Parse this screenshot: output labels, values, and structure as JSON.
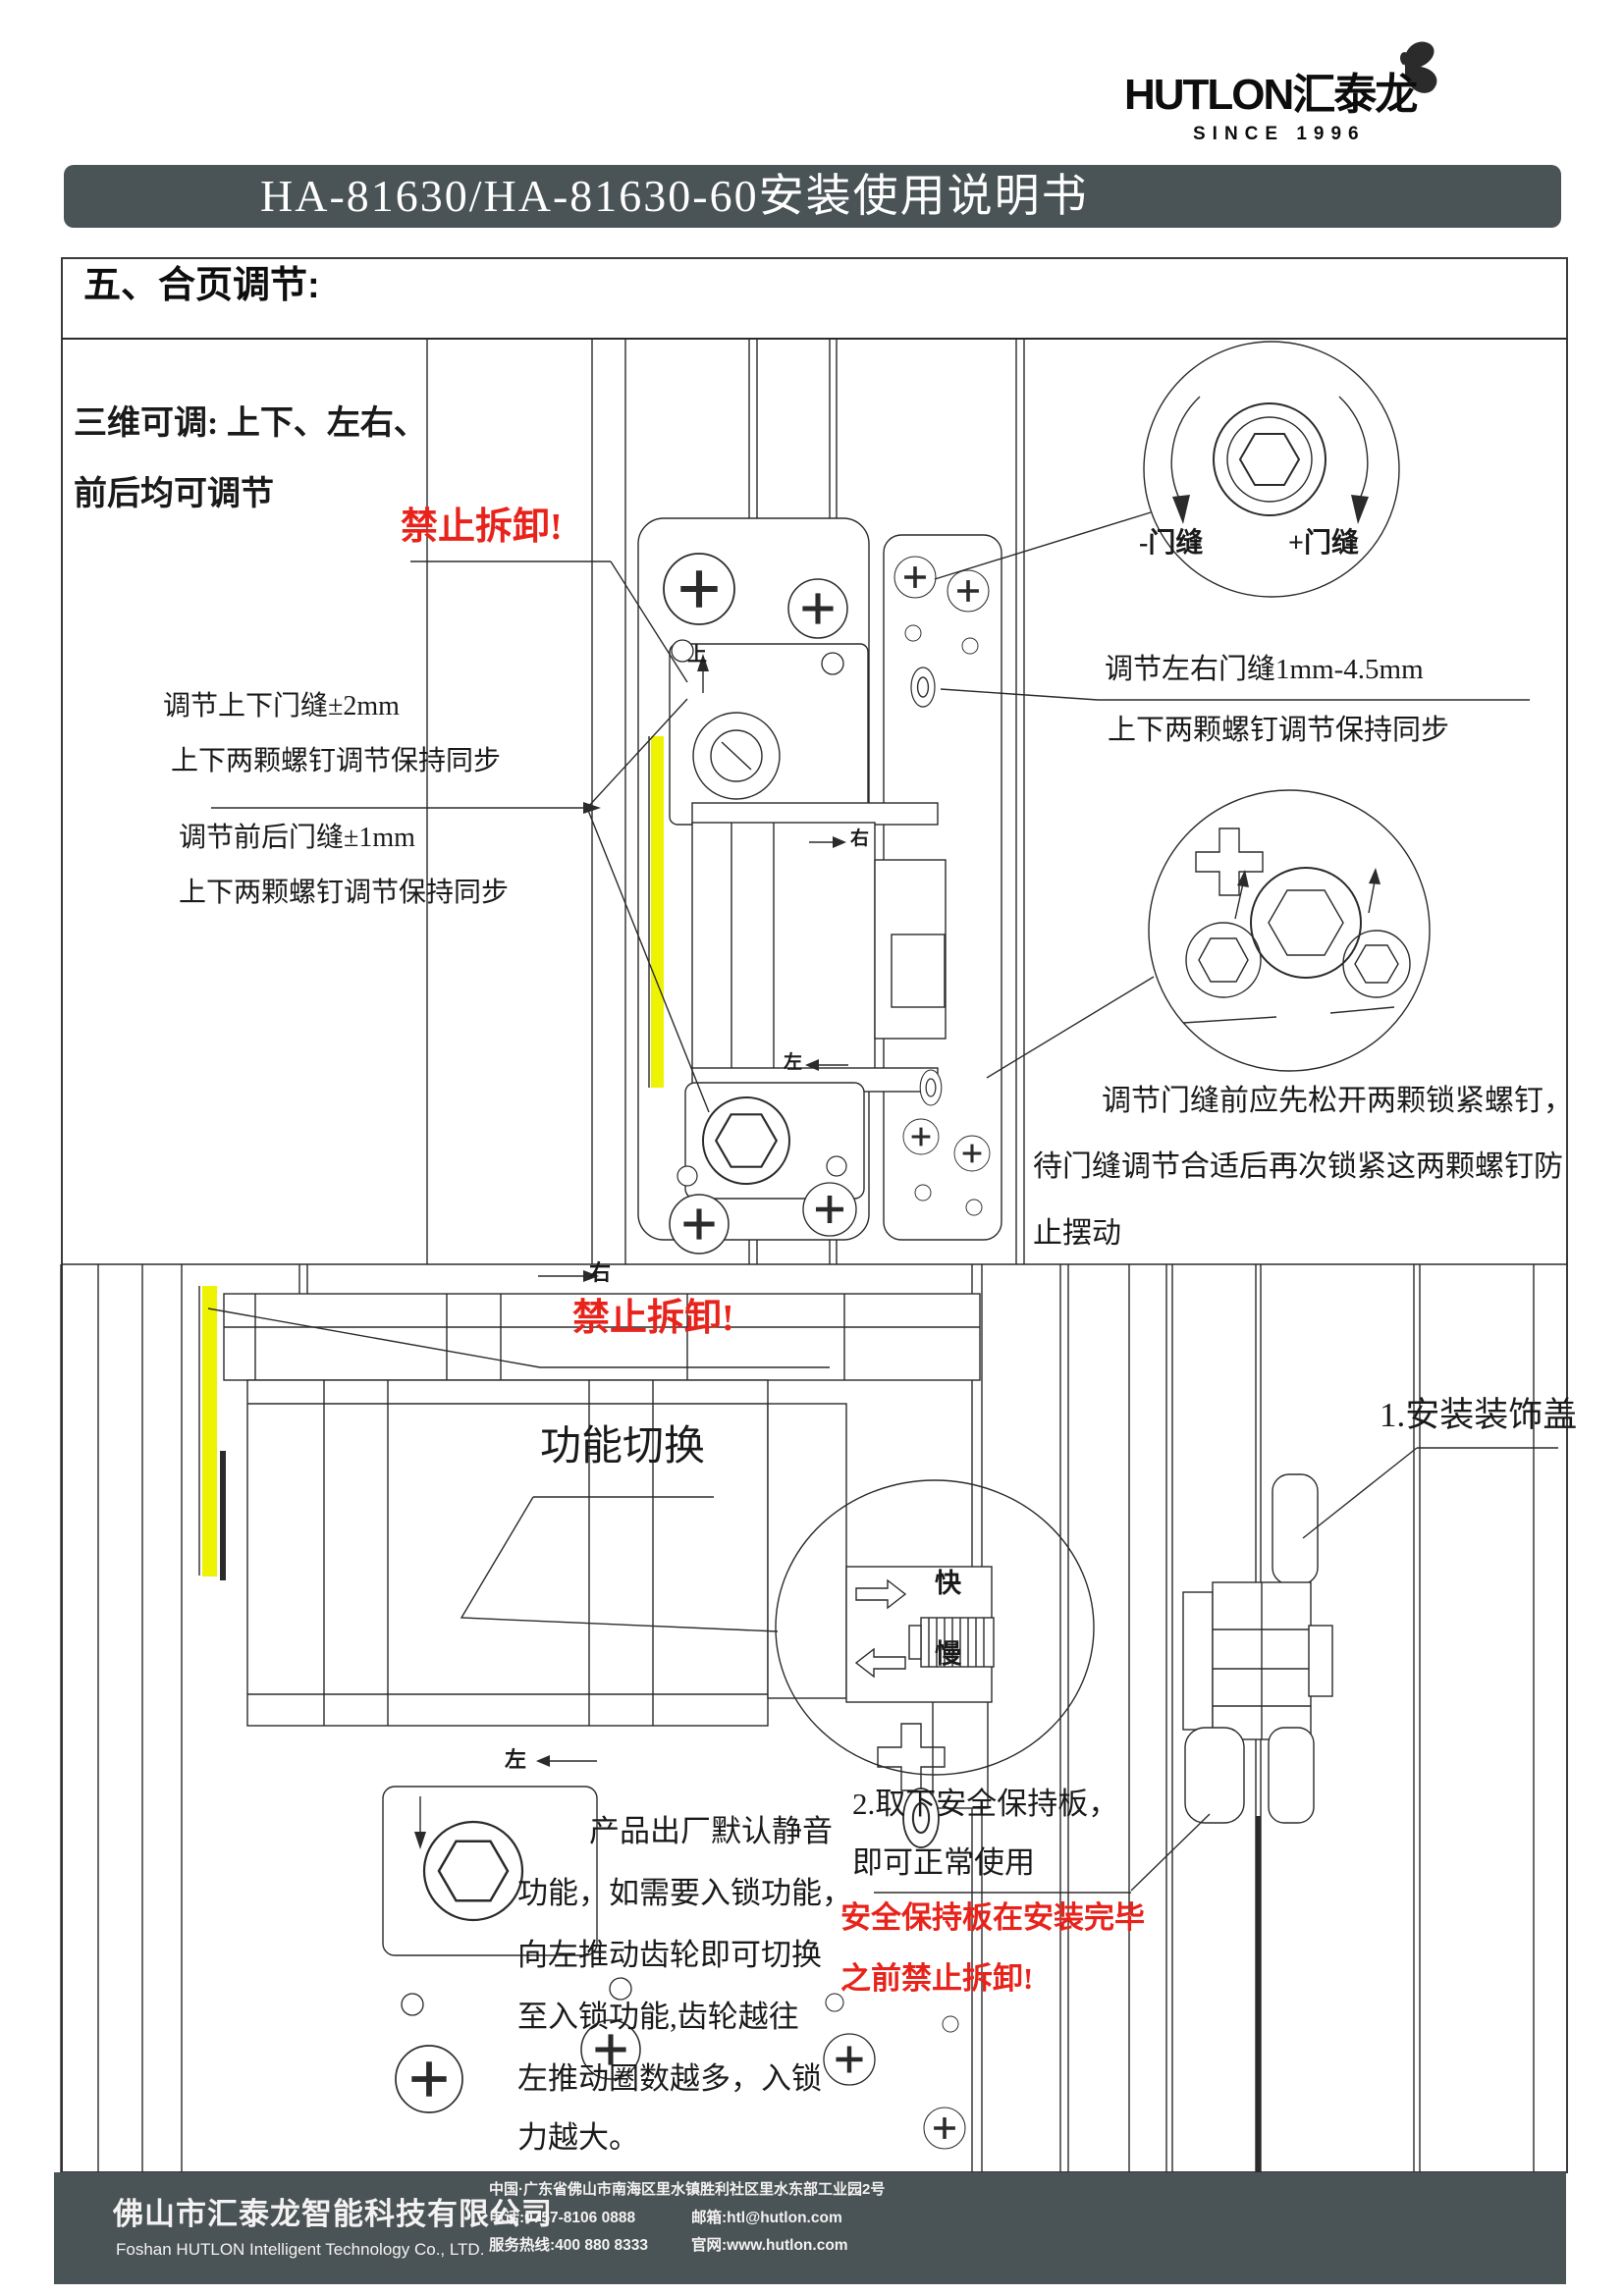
{
  "logo": {
    "brand_en": "HUTLON",
    "brand_cn": "汇泰龙",
    "since": "SINCE 1996"
  },
  "title_bar": {
    "text": "HA-81630/HA-81630-60安装使用说明书"
  },
  "section": {
    "heading": "五、合页调节:"
  },
  "panel1": {
    "intro_line1": "三维可调: 上下、左右、",
    "intro_line2": "前后均可调节",
    "no_disassemble": "禁止拆卸!",
    "note_updown_1": "调节上下门缝±2mm",
    "note_updown_2": "上下两颗螺钉调节保持同步",
    "note_frontback_1": "调节前后门缝±1mm",
    "note_frontback_2": "上下两颗螺钉调节保持同步",
    "gap_minus": "-门缝",
    "gap_plus": "+门缝",
    "note_leftright_1": "调节左右门缝1mm-4.5mm",
    "note_leftright_2": "上下两颗螺钉调节保持同步",
    "lock_note_1": "调节门缝前应先松开两颗锁紧螺钉，",
    "lock_note_2": "待门缝调节合适后再次锁紧这两颗螺钉防",
    "lock_note_3": "止摆动",
    "label_up": "上",
    "label_right": "右",
    "label_left": "左"
  },
  "panel2": {
    "no_disassemble": "禁止拆卸!",
    "function_switch": "功能切换",
    "label_fast": "快",
    "label_slow": "慢",
    "label_right": "右",
    "label_left": "左",
    "para_1": "产品出厂默认静音",
    "para_2": "功能，如需要入锁功能，",
    "para_3": "向左推动齿轮即可切换",
    "para_4": "至入锁功能,齿轮越往",
    "para_5": "左推动圈数越多，入锁",
    "para_6": "力越大。",
    "step1": "1.安装装饰盖",
    "step2_1": "2.取下安全保持板，",
    "step2_2": "即可正常使用",
    "warning_1": "安全保持板在安装完毕",
    "warning_2": "之前禁止拆卸!"
  },
  "footer": {
    "company_cn": "佛山市汇泰龙智能科技有限公司",
    "company_en": "Foshan HUTLON Intelligent Technology Co., LTD.",
    "address": "中国·广东省佛山市南海区里水镇胜利社区里水东部工业园2号",
    "phone": "电话:0757-8106 0888",
    "hotline": "服务热线:400 880 8333",
    "email": "邮箱:htl@hutlon.com",
    "website": "官网:www.hutlon.com"
  },
  "colors": {
    "bar_bg": "#4a5355",
    "warning_red": "#e8231b",
    "highlight_yellow": "#edf303",
    "line": "#2b2b2b"
  }
}
